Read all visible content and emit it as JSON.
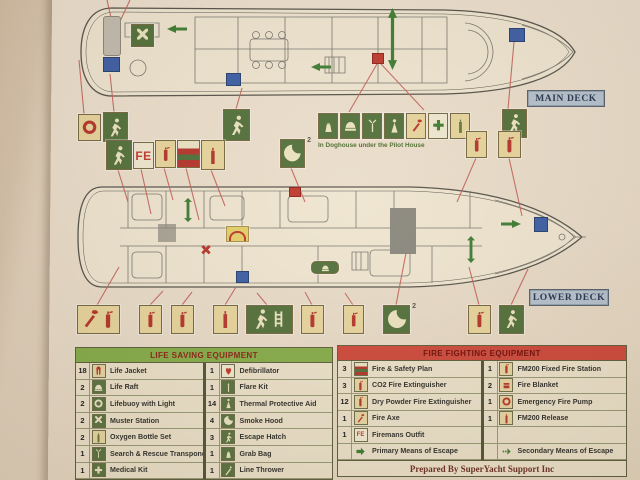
{
  "page": {
    "main_deck_label": "MAIN DECK",
    "lower_deck_label": "LOWER DECK",
    "doghouse_note": "In Doghouse under the Pilot House",
    "fe_symbol_text": "FE",
    "smoke_hood_superscript": "2",
    "colors": {
      "symbol_green": "#53713b",
      "symbol_tan": "#e8d59d",
      "pictogram_red": "#b5362c",
      "table_header_green": "#86ad4a",
      "table_header_red": "#cf4a3c",
      "deck_label_blue": "#b6c2ce",
      "connector_red": "#c4625a"
    }
  },
  "life_saving_table": {
    "title": "LIFE SAVING EQUIPMENT",
    "rows_left": [
      {
        "qty": "18",
        "icon": "life-jacket",
        "label": "Life Jacket"
      },
      {
        "qty": "2",
        "icon": "life-raft",
        "label": "Life Raft"
      },
      {
        "qty": "2",
        "icon": "lifebuoy",
        "label": "Lifebuoy with Light"
      },
      {
        "qty": "2",
        "icon": "muster-station",
        "label": "Muster Station"
      },
      {
        "qty": "2",
        "icon": "oxygen-bottle",
        "label": "Oxygen Bottle Set"
      },
      {
        "qty": "1",
        "icon": "sart",
        "label": "Search & Rescue Transponder"
      },
      {
        "qty": "1",
        "icon": "medical-kit",
        "label": "Medical Kit"
      }
    ],
    "rows_right": [
      {
        "qty": "1",
        "icon": "defibrillator",
        "label": "Defibrillator"
      },
      {
        "qty": "1",
        "icon": "flare-kit",
        "label": "Flare Kit"
      },
      {
        "qty": "14",
        "icon": "thermal-aid",
        "label": "Thermal Protective Aid"
      },
      {
        "qty": "4",
        "icon": "smoke-hood",
        "label": "Smoke Hood"
      },
      {
        "qty": "3",
        "icon": "escape-hatch",
        "label": "Escape Hatch"
      },
      {
        "qty": "1",
        "icon": "grab-bag",
        "label": "Grab Bag"
      },
      {
        "qty": "1",
        "icon": "line-thrower",
        "label": "Line Thrower"
      }
    ]
  },
  "fire_fighting_table": {
    "title": "FIRE FIGHTING EQUIPMENT",
    "footer": "Prepared By SuperYacht Support Inc",
    "rows_left": [
      {
        "qty": "3",
        "icon": "fire-safety-plan",
        "label": "Fire & Safety Plan"
      },
      {
        "qty": "3",
        "icon": "co2-extinguisher",
        "label": "CO2 Fire Extinguisher"
      },
      {
        "qty": "12",
        "icon": "dry-powder-extinguisher",
        "label": "Dry Powder Fire Extinguisher"
      },
      {
        "qty": "1",
        "icon": "fire-axe",
        "label": "Fire Axe"
      },
      {
        "qty": "1",
        "icon": "firemans-outfit",
        "label": "Firemans Outfit"
      },
      {
        "qty": "",
        "icon": "primary-escape-arrow",
        "label": "Primary Means of Escape"
      }
    ],
    "rows_right": [
      {
        "qty": "1",
        "icon": "fm200-station",
        "label": "FM200 Fixed Fire Station"
      },
      {
        "qty": "2",
        "icon": "fire-blanket",
        "label": "Fire Blanket"
      },
      {
        "qty": "1",
        "icon": "emergency-fire-pump",
        "label": "Emergency Fire Pump"
      },
      {
        "qty": "1",
        "icon": "fm200-release",
        "label": "FM200 Release"
      },
      {
        "qty": "",
        "icon": "",
        "label": ""
      },
      {
        "qty": "",
        "icon": "secondary-escape-arrow",
        "label": "Secondary Means of Escape"
      }
    ]
  }
}
